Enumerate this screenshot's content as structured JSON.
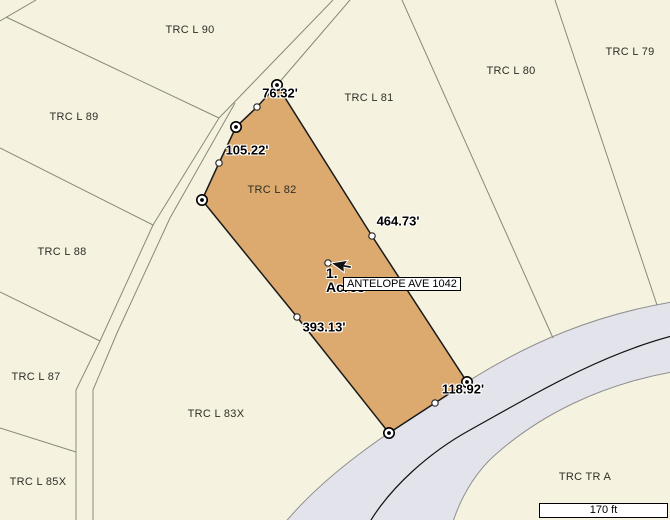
{
  "colors": {
    "background": "#f5f3e0",
    "selected_parcel_fill": "#dca96e",
    "selected_parcel_outline": "#1a1a1a",
    "parcel_line": "#8a8878",
    "road_fill": "#e3e3eb",
    "road_edge": "#8f8f8f",
    "road_centerline": "#111111",
    "parcel_label_text": "#2e2e26",
    "dimension_label_text": "#000000"
  },
  "parcel_labels": [
    {
      "text": "TRC L 90"
    },
    {
      "text": "TRC L 79"
    },
    {
      "text": "TRC L 80"
    },
    {
      "text": "TRC L 81"
    },
    {
      "text": "TRC L 89"
    },
    {
      "text": "TRC L 82"
    },
    {
      "text": "TRC L 88"
    },
    {
      "text": "TRC L 87"
    },
    {
      "text": "TRC L 83X"
    },
    {
      "text": "TRC L 85X"
    },
    {
      "text": "TRC TR A"
    }
  ],
  "dimension_labels": [
    {
      "text": "76.32'"
    },
    {
      "text": "105.22'"
    },
    {
      "text": "464.73'"
    },
    {
      "text": "393.13'"
    },
    {
      "text": "118.92'"
    }
  ],
  "selected_parcel": {
    "name": "TRC L 82",
    "area_line1": "1.",
    "area_line2": "Acres"
  },
  "tooltip": {
    "text": "ANTELOPE AVE 1042"
  },
  "scale_bar": {
    "text": "170 ft"
  }
}
